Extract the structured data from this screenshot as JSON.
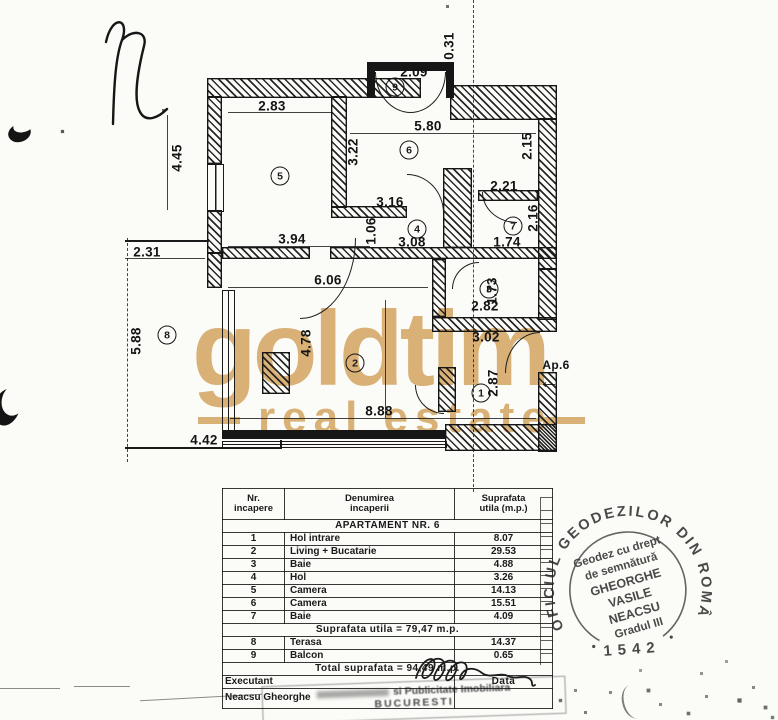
{
  "document": {
    "type": "cadastral apartment floor plan (scanned)",
    "colors": {
      "watermark_gold": "#d9b176",
      "ink": "#1a1a1a",
      "paper": "#fbfbf8"
    }
  },
  "watermark": {
    "line1": "goldtim",
    "line2": "real estate"
  },
  "plan": {
    "rooms": [
      "1",
      "2",
      "3",
      "4",
      "5",
      "6",
      "7",
      "8",
      "9"
    ],
    "dimensions": [
      "0.31",
      "2.09",
      "2.83",
      "5.80",
      "3.22",
      "2.15",
      "4.45",
      "2.21",
      "3.16",
      "1.06",
      "2.16",
      "3.94",
      "3.08",
      "1.74",
      "2.31",
      "6.06",
      "1.73",
      "2.82",
      "3.02",
      "4.78",
      "5.88",
      "2.87",
      "8.88",
      "4.42"
    ],
    "entrance": {
      "label": "Ap.6",
      "arrow_glyph": "←"
    }
  },
  "table": {
    "headers": {
      "col1": "Nr. incapere",
      "col2": "Denumirea incaperii",
      "col3": "Suprafata utila (m.p.)"
    },
    "section_title": "APARTAMENT NR. 6",
    "rows": [
      {
        "nr": "1",
        "name": "Hol intrare",
        "area": "8.07"
      },
      {
        "nr": "2",
        "name": "Living + Bucatarie",
        "area": "29.53"
      },
      {
        "nr": "3",
        "name": "Baie",
        "area": "4.88"
      },
      {
        "nr": "4",
        "name": "Hol",
        "area": "3.26"
      },
      {
        "nr": "5",
        "name": "Camera",
        "area": "14.13"
      },
      {
        "nr": "6",
        "name": "Camera",
        "area": "15.51"
      },
      {
        "nr": "7",
        "name": "Baie",
        "area": "4.09"
      }
    ],
    "subtotal": "Suprafata utila = 79,47 m.p.",
    "rows2": [
      {
        "nr": "8",
        "name": "Terasa",
        "area": "14.37"
      },
      {
        "nr": "9",
        "name": "Balcon",
        "area": "0.65"
      }
    ],
    "total": "Total suprafata = 94,49 m.p.",
    "executant_label": "Executant",
    "data_label": "Data",
    "executant_name": "Neacsu Gheorghe"
  },
  "stamp": {
    "ring_text": "OFICIUL GEODEZILOR DIN ROMÂNIA",
    "line1": "Geodez cu drept",
    "line2": "de semnătură",
    "line3": "GHEORGHE",
    "line4": "VASILE",
    "line5": "NEACSU",
    "line6": "Gradul III",
    "number": "1542"
  },
  "footer": {
    "line1": "si Publicitate Imobiliara",
    "line2": "BUCURESTI"
  }
}
